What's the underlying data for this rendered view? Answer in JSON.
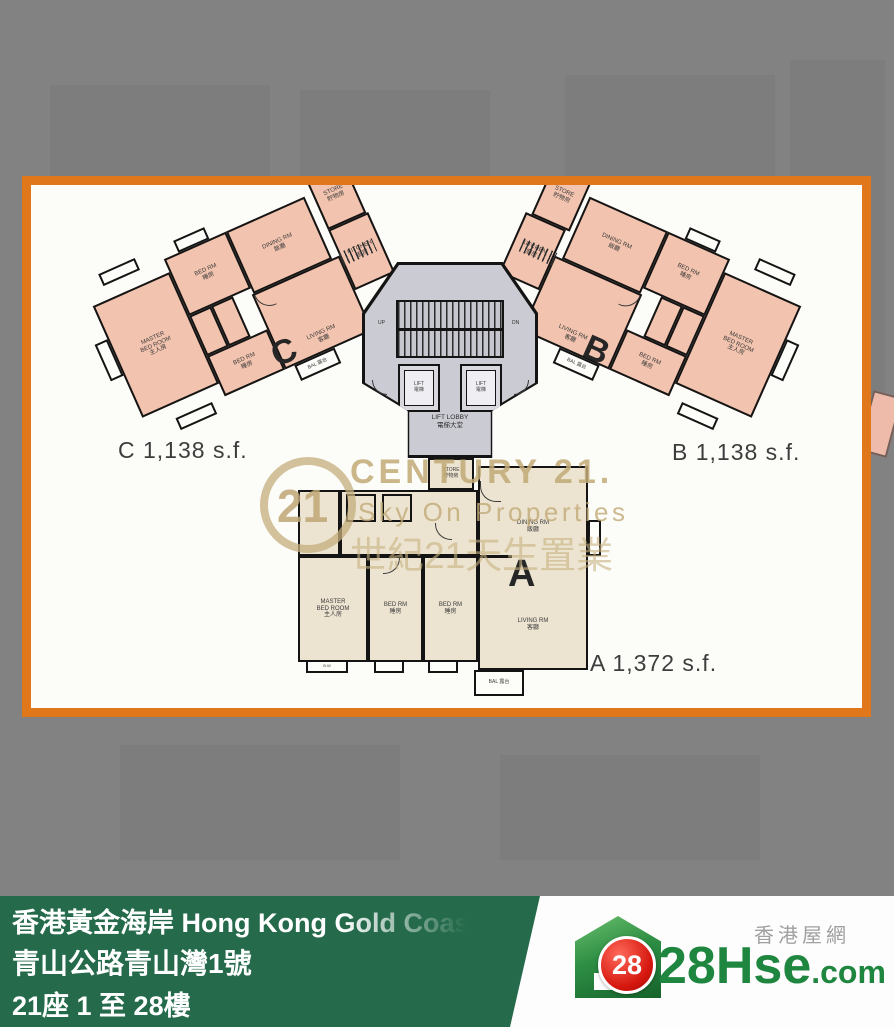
{
  "colors": {
    "background": "#828282",
    "frame_border": "#E0771B",
    "plan_paper": "#FCFCF8",
    "unit_bc_fill": "#F2C3AE",
    "unit_a_fill": "#ECE3D0",
    "lobby_fill": "#CBCBD3",
    "wall": "#141414",
    "watermark_tan": "#C8B17E",
    "footer_green": "#246A4B",
    "logo_green": "#1F8640",
    "badge_red": "#D5170E",
    "tagline_gray": "#A0A0A0"
  },
  "plan": {
    "lobby": {
      "lift": "LIFT\n電梯",
      "label": "LIFT LOBBY\n電梯大堂",
      "up": "UP",
      "dn": "DN"
    },
    "units": {
      "c": {
        "letter": "C",
        "area": "C 1,138 s.f.",
        "rooms": {
          "master": "MASTER\nBED ROOM\n主人房",
          "bed1": "BED RM\n睡房",
          "bed2": "BED RM\n睡房",
          "dining": "DINING RM\n飯廳",
          "living": "LIVING RM\n客廳",
          "kitchen": "KITCHEN\n廚房",
          "store": "STORE\n貯物房",
          "bal": "BAL 露台"
        }
      },
      "b": {
        "letter": "B",
        "area": "B 1,138 s.f.",
        "rooms": {
          "master": "MASTER\nBED ROOM\n主人房",
          "bed1": "BED RM\n睡房",
          "bed2": "BED RM\n睡房",
          "dining": "DINING RM\n飯廳",
          "living": "LIVING RM\n客廳",
          "kitchen": "KITCHEN\n廚房",
          "store": "STORE\n貯物房",
          "bal": "BAL 露台"
        }
      },
      "a": {
        "letter": "A",
        "area": "A 1,372 s.f.",
        "rooms": {
          "master": "MASTER\nBED ROOM\n主人房",
          "bed1": "BED RM\n睡房",
          "bed2": "BED RM\n睡房",
          "dining": "DINING RM\n飯廳",
          "living": "LIVING RM\n客廳",
          "kitchen": "KITCHEN\n廚房",
          "store": "STORE\n貯物房",
          "bal": "BAL 露台",
          "bw": "B.W"
        }
      }
    }
  },
  "watermark": {
    "logo_number": "21",
    "brand": "CENTURY 21.",
    "subtitle": "Sky On Properties",
    "chinese": "世紀21天生置業"
  },
  "footer": {
    "line1": "香港黃金海岸 Hong Kong Gold Coast",
    "line2": "青山公路青山灣1號",
    "line3": "21座 1 至 28樓"
  },
  "logo": {
    "badge": "28",
    "name": "28Hse",
    "tld": ".com",
    "tagline": "香港屋網"
  }
}
